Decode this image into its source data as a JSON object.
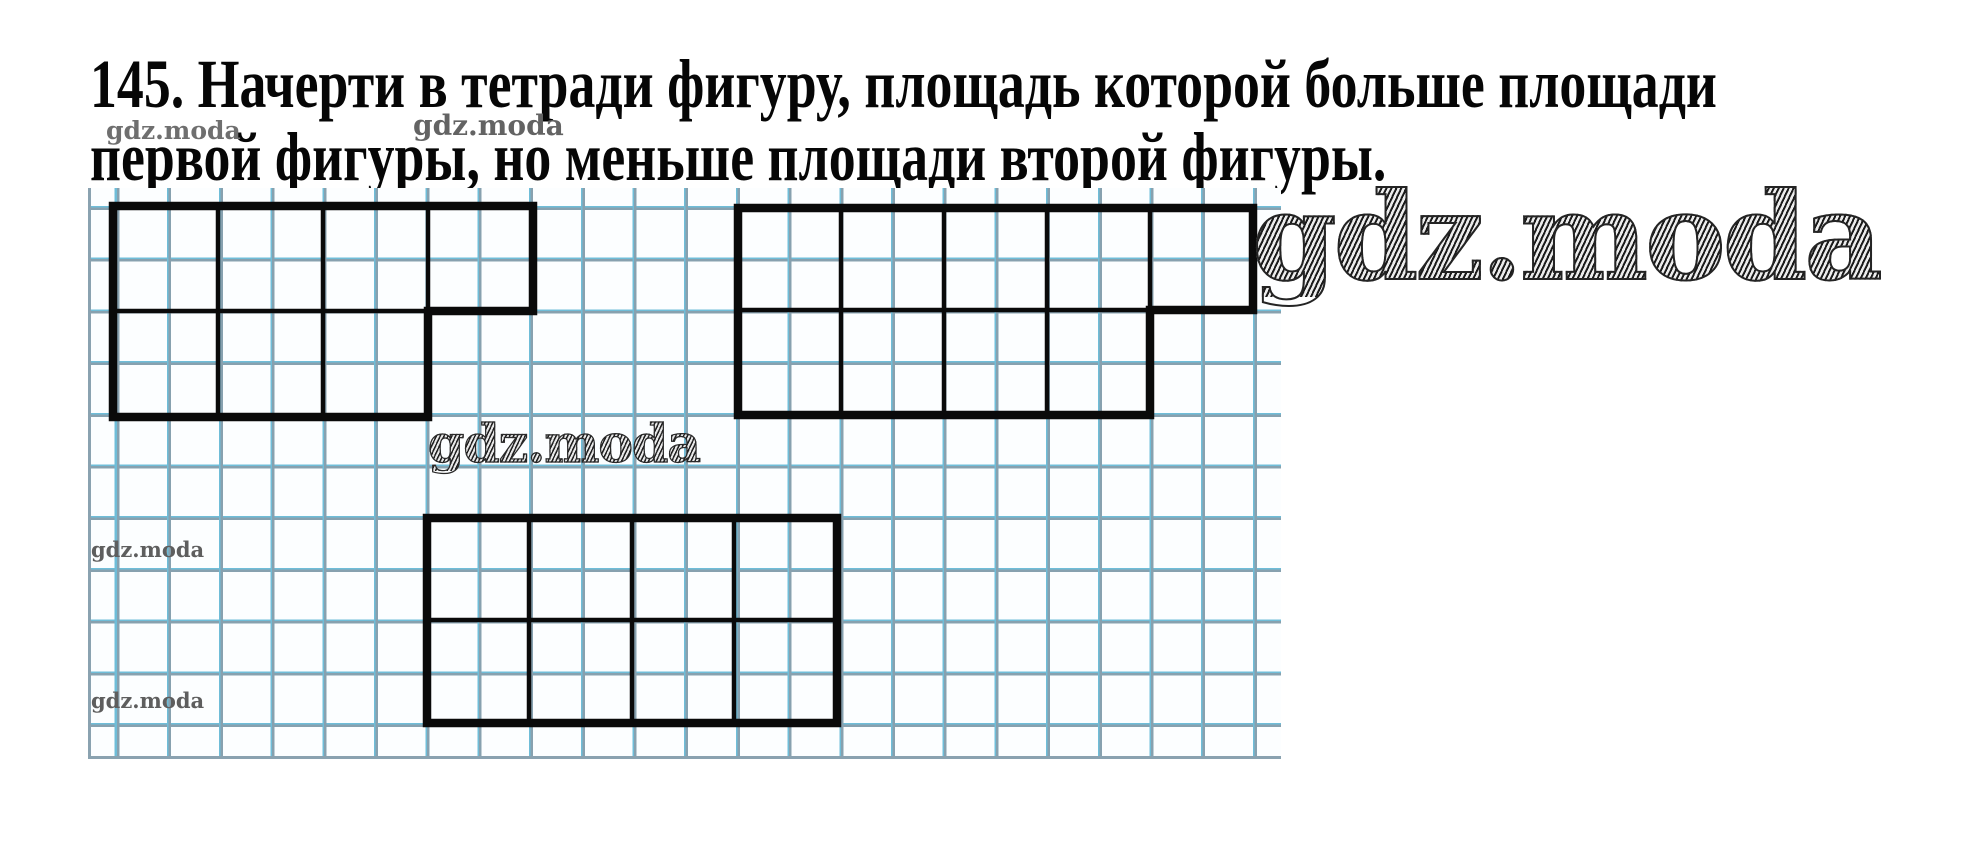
{
  "task": {
    "line1": "145. Начерти в тетради фигуру, площадь которой больше площади",
    "line2": "первой фигуры, но меньше площади второй фигуры."
  },
  "watermarks": {
    "top_left": "gdz.moda",
    "top_middle": "gdz.moda",
    "large_right": "gdz.moda",
    "middle": "gdz.moda",
    "left_upper": "gdz.moda",
    "left_lower": "gdz.moda"
  },
  "paper": {
    "background": "#fcfeff",
    "grid_line_cyan": "#6fbdd8",
    "grid_line_gray": "#87a1af",
    "cell_px": 51.7,
    "figure_line_color": "#0a0a0a"
  },
  "figures": [
    {
      "name": "figure-1",
      "shape": "L-shape, 4 blocks in top row and 3 blocks in bottom row, each block 2x2 grid cells",
      "outline": [
        [
          113,
          206
        ],
        [
          533,
          206
        ],
        [
          533,
          311
        ],
        [
          428,
          311
        ],
        [
          428,
          417
        ],
        [
          113,
          417
        ]
      ],
      "internal_vertical": [
        {
          "x": 218,
          "y1": 206,
          "y2": 417
        },
        {
          "x": 323,
          "y1": 206,
          "y2": 417
        },
        {
          "x": 428,
          "y1": 206,
          "y2": 311
        }
      ],
      "internal_horizontal": [
        {
          "y": 311,
          "x1": 113,
          "x2": 428
        }
      ]
    },
    {
      "name": "figure-2",
      "shape": "L-shape, 5 blocks in top row and 4 blocks in bottom row, each block 2x2 grid cells",
      "outline": [
        [
          738,
          208
        ],
        [
          1253,
          208
        ],
        [
          1253,
          310
        ],
        [
          1150,
          310
        ],
        [
          1150,
          415
        ],
        [
          738,
          415
        ]
      ],
      "internal_vertical": [
        {
          "x": 841,
          "y1": 208,
          "y2": 415
        },
        {
          "x": 944,
          "y1": 208,
          "y2": 415
        },
        {
          "x": 1047,
          "y1": 208,
          "y2": 415
        },
        {
          "x": 1150,
          "y1": 208,
          "y2": 310
        }
      ],
      "internal_horizontal": [
        {
          "y": 310,
          "x1": 738,
          "x2": 1150
        }
      ]
    },
    {
      "name": "figure-3",
      "shape": "rectangle, 4 blocks by 2 blocks, each block 2x2 grid cells",
      "outline": [
        [
          427,
          518
        ],
        [
          837,
          518
        ],
        [
          837,
          723
        ],
        [
          427,
          723
        ]
      ],
      "internal_vertical": [
        {
          "x": 529,
          "y1": 518,
          "y2": 723
        },
        {
          "x": 632,
          "y1": 518,
          "y2": 723
        },
        {
          "x": 734,
          "y1": 518,
          "y2": 723
        }
      ],
      "internal_horizontal": [
        {
          "y": 620,
          "x1": 427,
          "x2": 837
        }
      ]
    }
  ]
}
